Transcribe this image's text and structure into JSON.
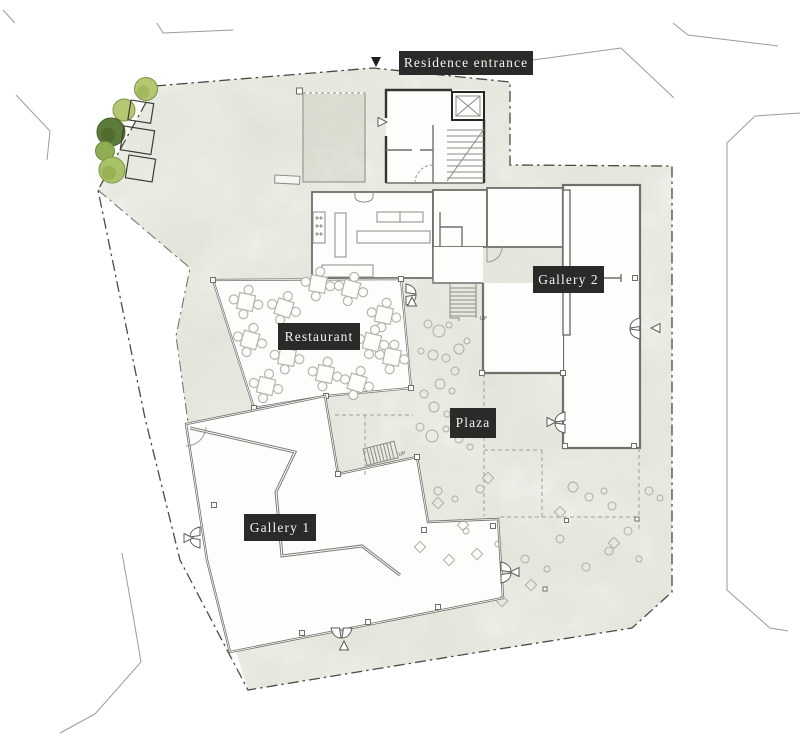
{
  "plan": {
    "labels": {
      "residence_entrance": "Residence entrance",
      "gallery_2": "Gallery 2",
      "restaurant": "Restaurant",
      "plaza": "Plaza",
      "gallery_1": "Gallery 1",
      "stair_up": "UP"
    },
    "icons": {
      "entrance_pointer": "triangle-down-filled",
      "door_direction_marker": "triangle-outline",
      "double_door": "butterfly-door-swing",
      "elevator": "crossed-box",
      "stair": "hatched-treads"
    },
    "colors": {
      "label_bg": "#2b2a28",
      "label_text": "#f5f4f0",
      "ground_base": "#eff0e9",
      "ground_mottle": "#c8cdbd",
      "boundary": "#4a4b45",
      "wall": "#6f706a",
      "wall_dark": "#33332f",
      "furniture": "#b2b7ab",
      "scatter": "#aab0a2",
      "street": "#9b9c96",
      "tree_dark": "#5e7c39",
      "tree_mid": "#8fae54",
      "tree_light": "#b5c773"
    }
  }
}
